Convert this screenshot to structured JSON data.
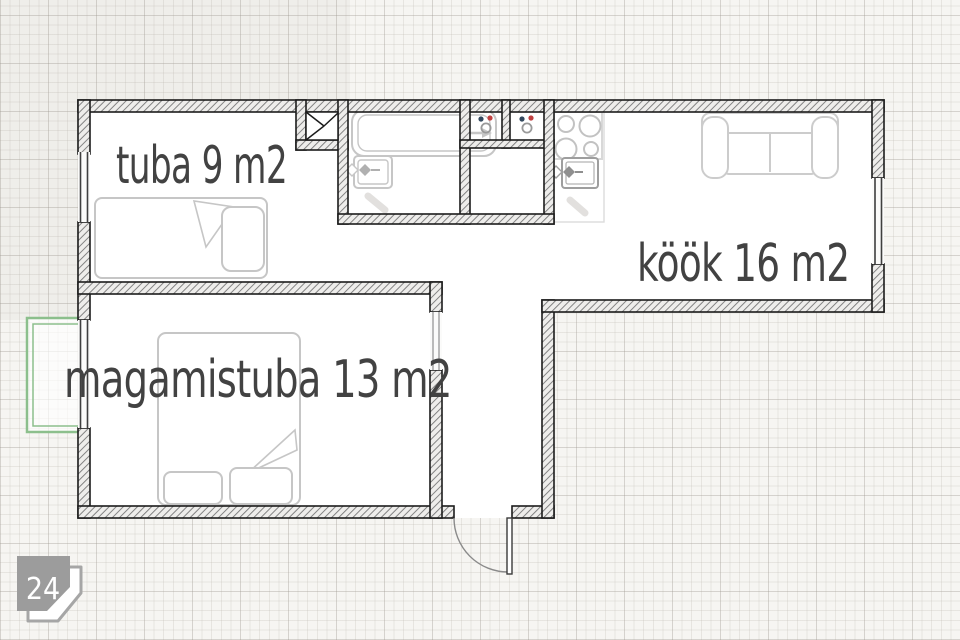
{
  "document": {
    "type": "apartment-floor-plan"
  },
  "rooms": {
    "tuba": {
      "label": "tuba 9 m2",
      "name": "tuba",
      "area_m2": 9
    },
    "kook": {
      "label": "köök 16 m2",
      "name": "köök",
      "area_m2": 16
    },
    "magamistuba": {
      "label": "magamistuba 13 m2",
      "name": "magamistuba",
      "area_m2": 13
    }
  },
  "badge": {
    "number": "24"
  },
  "fixtures": [
    "single-bed",
    "double-bed",
    "bathtub",
    "washbasin",
    "water-meters",
    "stove-4-burners",
    "kitchen-sink",
    "sofa",
    "balcony",
    "ventilation-shaft",
    "entrance-door",
    "windows"
  ],
  "colors": {
    "wall_outline": "#1c1c1c",
    "wall_hatch": "#777777",
    "furniture": "#c6c6c6",
    "balcony_green": "#8cbf8c",
    "label_text": "#424242",
    "badge_gray": "#9c9c9c",
    "meter_red": "#c04040",
    "meter_blue": "#33485e"
  }
}
